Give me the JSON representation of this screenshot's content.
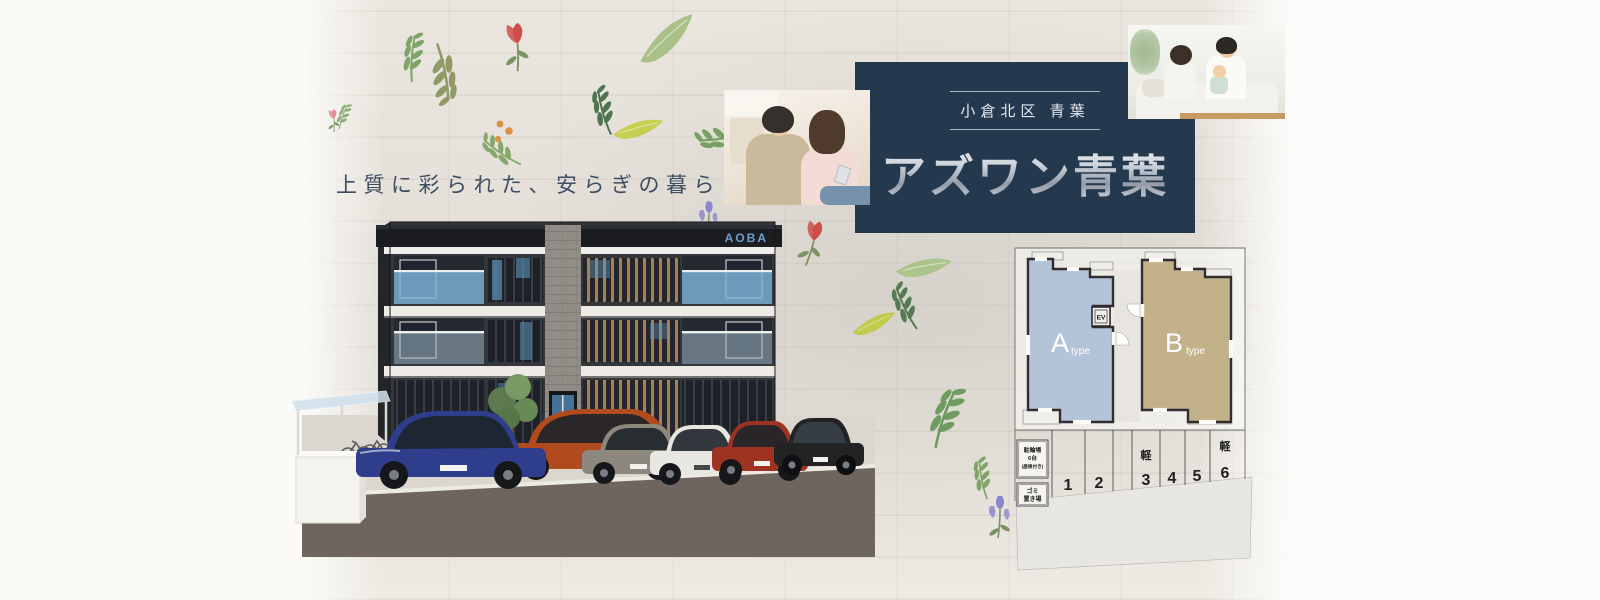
{
  "tagline": {
    "text": "上質に彩られた、安らぎの暮らし。"
  },
  "title_block": {
    "location_label": "小倉北区 青葉",
    "title": "アズワン青葉",
    "background_color": "#24384e",
    "title_color": "#ccd3db"
  },
  "building": {
    "sign_label": "AOBA",
    "sign_color": "#6d9fd0",
    "cars": [
      {
        "name": "car-blue",
        "color": "#2f3e8c"
      },
      {
        "name": "car-orange",
        "color": "#b14a1e"
      },
      {
        "name": "car-gray",
        "color": "#8d887d"
      },
      {
        "name": "car-white",
        "color": "#e9e7e2"
      },
      {
        "name": "car-red",
        "color": "#9e3322"
      },
      {
        "name": "car-black",
        "color": "#232326"
      }
    ]
  },
  "floor_plan": {
    "unit_a": {
      "letter": "A",
      "suffix": "type",
      "color": "#b3c3d8"
    },
    "unit_b": {
      "letter": "B",
      "suffix": "type",
      "color": "#c2b189"
    },
    "elevator_label": "EV",
    "bicycle_parking": {
      "line1": "駐輪場",
      "line2": "6台",
      "line3": "(屋根付き)"
    },
    "garbage_area": {
      "line1": "ゴミ",
      "line2": "置き場"
    },
    "parking_spaces": [
      {
        "num": "1",
        "kei": ""
      },
      {
        "num": "2",
        "kei": ""
      },
      {
        "num": "3",
        "kei": "軽"
      },
      {
        "num": "4",
        "kei": ""
      },
      {
        "num": "5",
        "kei": ""
      },
      {
        "num": "6",
        "kei": "軽"
      }
    ]
  }
}
